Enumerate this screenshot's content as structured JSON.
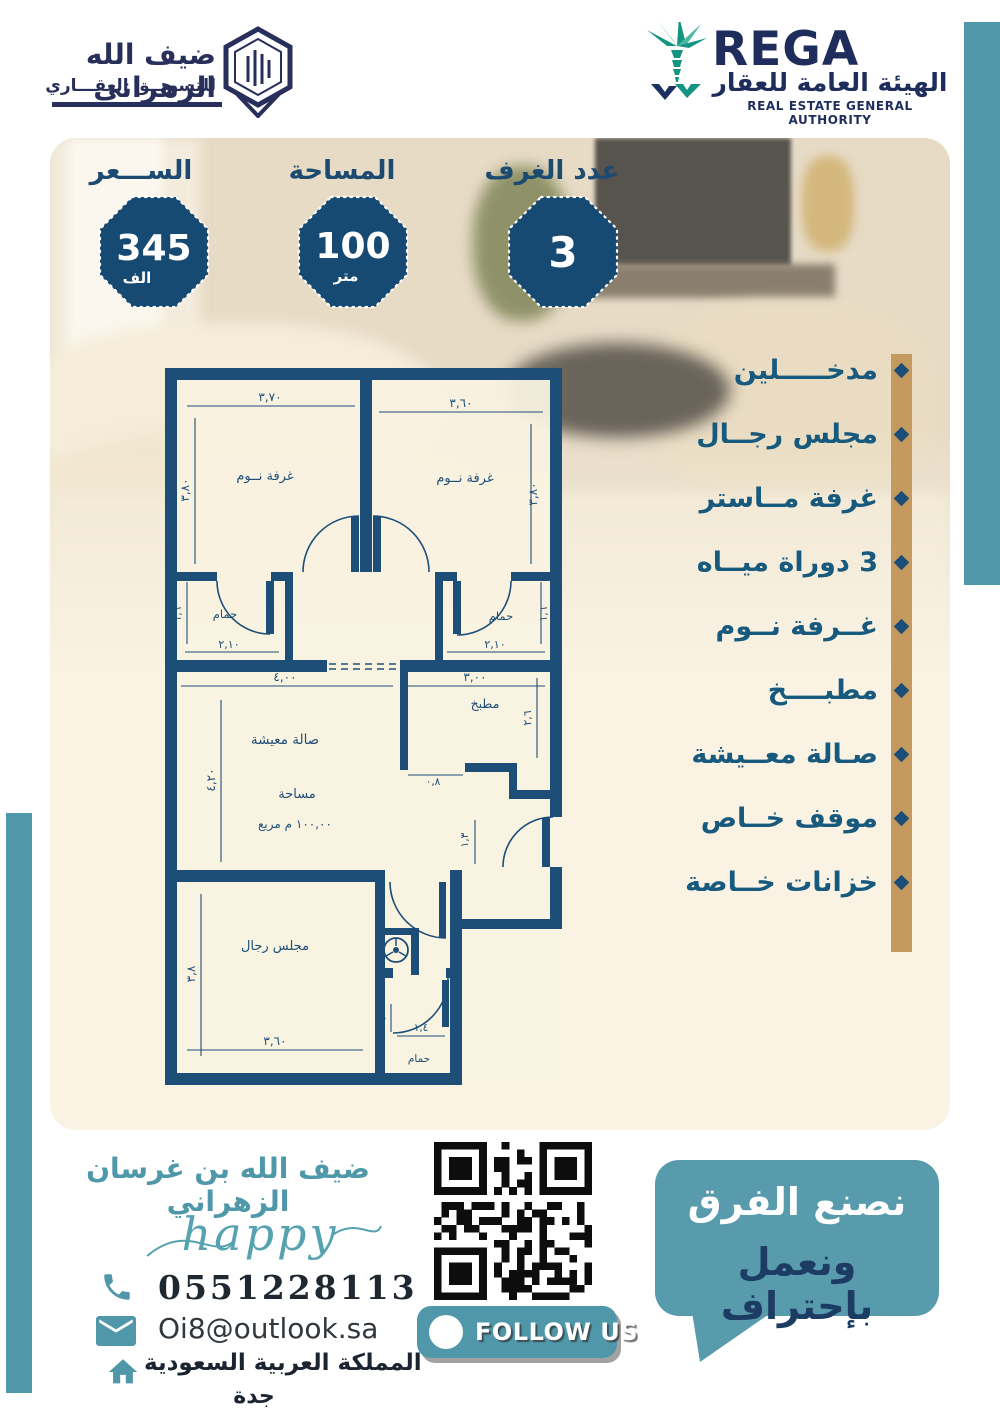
{
  "brand": {
    "title": "ضيف الله الزهراني",
    "subtitle": "للتسويــق العقـــاري"
  },
  "rega": {
    "acronym": "REGA",
    "name_ar": "الهيئة العامة للعقار",
    "name_en": "REAL ESTATE GENERAL AUTHORITY"
  },
  "badges": [
    {
      "label": "الســـعر",
      "value": "345",
      "unit": "الف"
    },
    {
      "label": "المساحة",
      "value": "100",
      "unit": "متر"
    },
    {
      "label": "عدد الغرف",
      "value": "3",
      "unit": ""
    }
  ],
  "features": [
    {
      "label": "مدخـــــلين"
    },
    {
      "label": "مجلس رجــال"
    },
    {
      "label": "غرفة مــاستر"
    },
    {
      "label": "3 دوراة ميــاه"
    },
    {
      "label": "غــرفة نــوم"
    },
    {
      "label": "مطبــــخ"
    },
    {
      "label": "صـالة معــيشة"
    },
    {
      "label": "موقف خــاص"
    },
    {
      "label": "خزانات خــاصة"
    }
  ],
  "plan": {
    "bedroom_left": "غرفة نــوم",
    "bedroom_right": "غرفة نــوم",
    "bath": "حمام",
    "kitchen": "مطبخ",
    "living": "صالة معيشة",
    "area_word": "مساحة",
    "area_value": "١٠٠,٠٠ م مربع",
    "majlis": "مجلس رجال",
    "dims": {
      "bed_left_w": "٣,٧٠",
      "bed_right_w": "٣,٦٠",
      "bed_h": "٣,٨٠",
      "bath_w": "٢,١٠",
      "bath_h": "١,٦",
      "living_w": "٤,٠٠",
      "kitchen_w": "٣,٠٠",
      "kitchen_h": "٢,٦",
      "kitchen_open": "٠,٨",
      "living_h": "٤,٢٠",
      "entry": "١,٣",
      "majlis_h": "٣,٨",
      "majlis_w": "٣,٦٠",
      "bath2_w": "١,٤",
      "bath2_h": "١,٦"
    }
  },
  "contact": {
    "name": "ضيف الله بن غرسان الزهراني",
    "signature": "happy",
    "phone": "0551228113",
    "email": "Oi8@outlook.sa",
    "country": "المملكة العربية السعودية",
    "city": "جدة"
  },
  "cta": {
    "follow": "FOLLOW US",
    "slogan_white": "نصنع الفرق",
    "slogan_dark": "ونعمل بإحتراف"
  },
  "colors": {
    "navy": "#1d4e78",
    "teal": "#4f97a9",
    "gold": "#c49a5f",
    "cream": "#faf3e4",
    "badge_navy": "#164a72",
    "logo_navy": "#282f5a",
    "rega_navy": "#1e2d5b"
  }
}
